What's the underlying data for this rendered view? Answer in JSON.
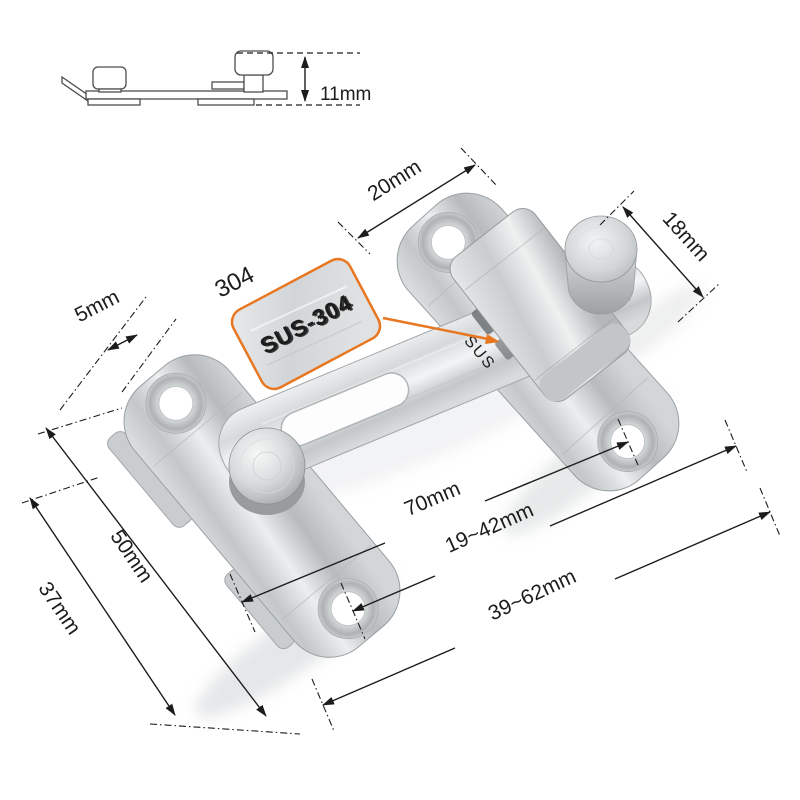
{
  "title": "stainless steel flip latch dimension diagram",
  "colors": {
    "accent_orange": "#e87722",
    "dimension_line": "#1c1c1c",
    "steel_light": "#f1f2f3",
    "steel_mid": "#c7cbcd",
    "steel_dark": "#9aa0a3",
    "background": "#ffffff"
  },
  "side_view": {
    "height": "11mm"
  },
  "callout": {
    "grade_label": "304",
    "stamp_text": "SUS-304",
    "plate_engraving": "SUS"
  },
  "dimensions": {
    "top_edge": "20mm",
    "knob": "18mm",
    "lip": "5mm",
    "plate_length": "50mm",
    "plate_width": "37mm",
    "bar": "70mm",
    "inner_range": "19~42mm",
    "outer_range": "39~62mm"
  }
}
